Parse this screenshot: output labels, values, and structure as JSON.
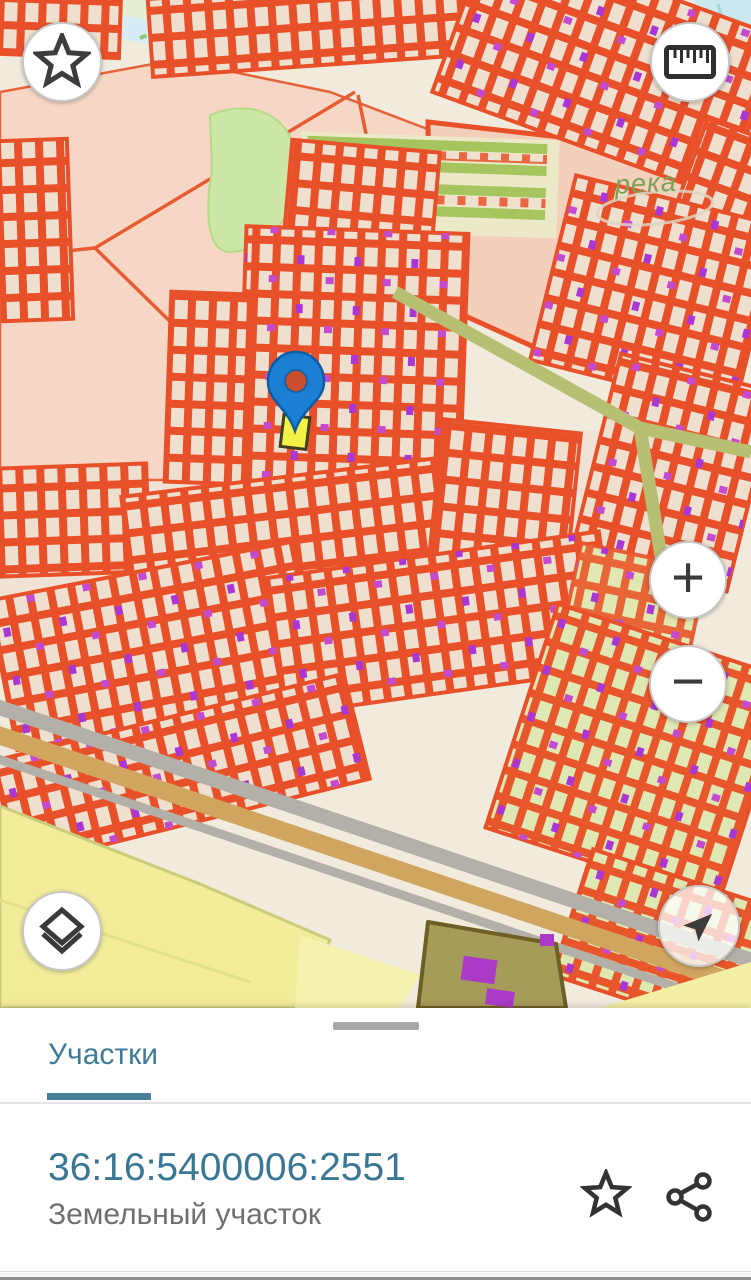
{
  "map": {
    "labels": {
      "river": "река"
    },
    "marker": {
      "description": "selected parcel pin with yellow highlighted parcel"
    }
  },
  "map_controls": {
    "favorites_icon": "star-icon",
    "measure_icon": "ruler-icon",
    "zoom_in_label": "+",
    "zoom_out_label": "−",
    "layers_icon": "layers-icon",
    "compass_icon": "navigation-arrow-icon"
  },
  "bottom_sheet": {
    "tab_label": "Участки",
    "parcel": {
      "cadastral_number": "36:16:5400006:2551",
      "type_label": "Земельный участок"
    },
    "actions": {
      "favorite_icon": "star-icon",
      "share_icon": "share-icon"
    }
  },
  "colors": {
    "accent_teal": "#3e7b98",
    "parcel_red": "#e8502a",
    "quarter_pink": "#f6d6c5",
    "background_beige": "#f0ebdd",
    "field_yellow": "#f1ec9d",
    "building_purple": "#b13ecf",
    "road_gray": "#b2b0a8",
    "road_tan": "#cfa55f",
    "pin_blue": "#1b80d4",
    "highlight_yellow": "#f4f145"
  }
}
